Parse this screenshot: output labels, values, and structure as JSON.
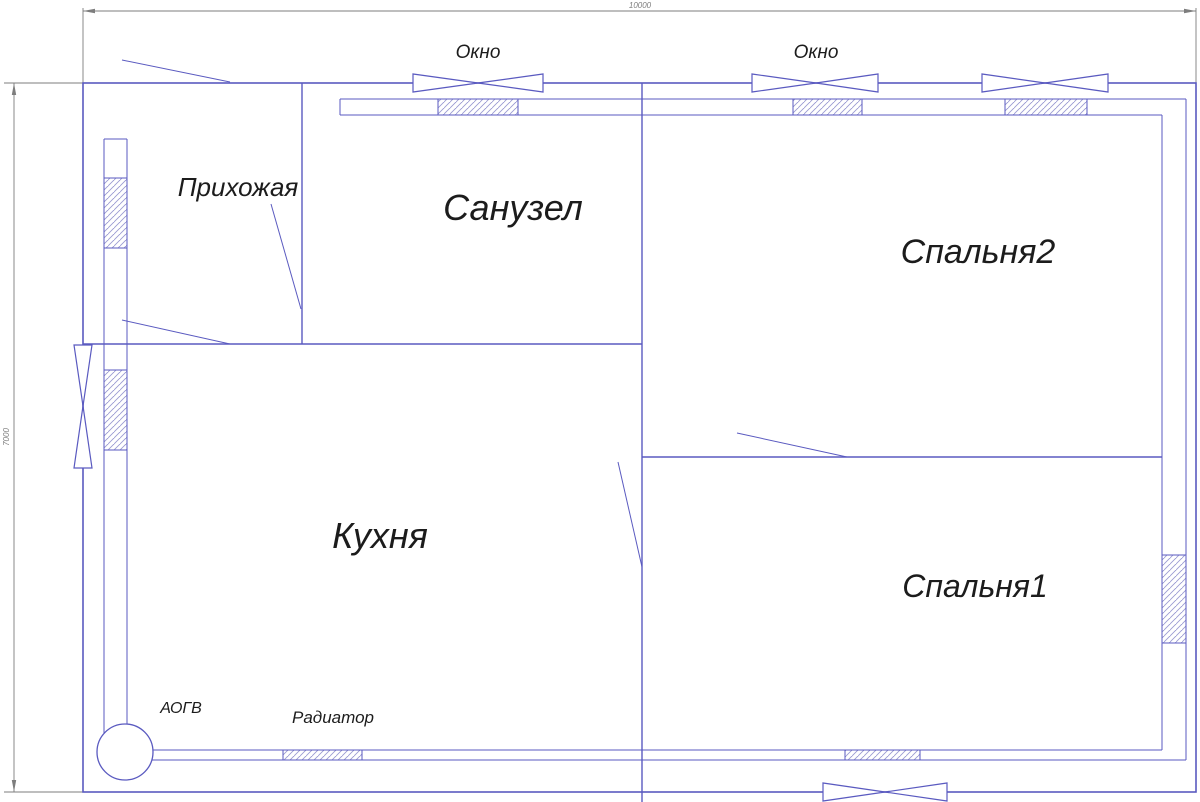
{
  "drawing": {
    "title": "floor-plan",
    "dimensions": {
      "width_label": "10000",
      "height_label": "7000"
    },
    "rooms": {
      "hallway": "Прихожая",
      "bathroom": "Санузел",
      "bedroom2": "Спальня2",
      "kitchen": "Кухня",
      "bedroom1": "Спальня1"
    },
    "labels": {
      "window1": "Окно",
      "window2": "Окно",
      "boiler": "АОГВ",
      "radiator": "Радиатор"
    },
    "colors": {
      "wall": "#5a5ac0",
      "hatch": "#9a9ad2",
      "dimension": "#7d7d7d",
      "text": "#1c1c1c",
      "background": "#ffffff"
    }
  }
}
